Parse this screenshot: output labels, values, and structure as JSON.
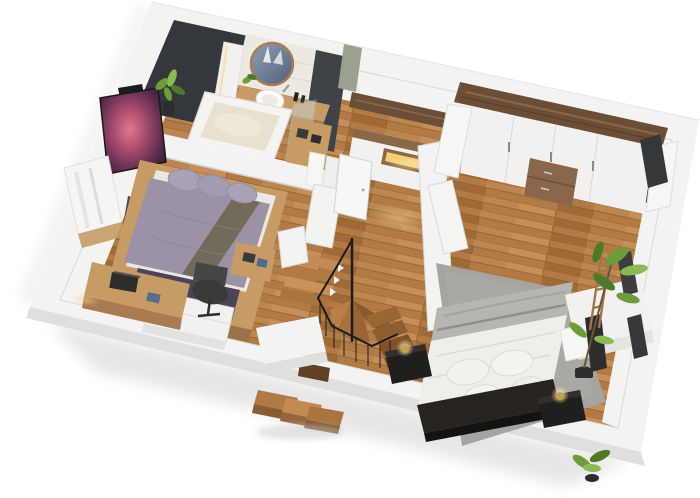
{
  "title": "3D cutaway floor plan render of an upper storey",
  "scene": {
    "description": "Isometric dollhouse-style 3D render of an apartment floor on a white background: bathroom at top left, bedroom with lavender bed and desk at left, central hallway with winder staircase, large bedroom with white bed and wardrobe at right",
    "rooms": [
      {
        "name": "bathroom",
        "items": [
          "bathtub",
          "wood-vanity-counter",
          "round-vessel-sink",
          "round-wall-mirror",
          "led-mirror-cabinet",
          "dark-accent-walls",
          "white-tile-wall",
          "hanging-towels",
          "glass-shower-screen",
          "small-plant"
        ]
      },
      {
        "name": "left-bedroom",
        "items": [
          "double-bed-lavender-bedding",
          "olive-accent-stripe",
          "purple-foot-runner",
          "white-foot-bench",
          "wood-platform",
          "desk-with-laptop",
          "office-chair",
          "wall-tv-nebula-image",
          "window-with-curtain",
          "dark-side-unit",
          "side-table",
          "potted-plant"
        ]
      },
      {
        "name": "hallway",
        "items": [
          "white-console-with-lit-niche",
          "walnut-wall-shelf",
          "open-white-door",
          "warm-floor-light",
          "sage-wall-accent"
        ]
      },
      {
        "name": "staircase",
        "items": [
          "upper-wood-flight",
          "winder-treads",
          "lower-wood-flight",
          "black-metal-railing",
          "balusters",
          "white-half-walls",
          "external-steps-below-front-wall"
        ]
      },
      {
        "name": "right-bedroom",
        "items": [
          "double-bed-white-bedding",
          "gray-folded-blanket",
          "black-headboard",
          "black-nightstand-left",
          "black-nightstand-right",
          "brass-ball-lamps",
          "gray-area-rug",
          "white-wardrobe-walnut-top",
          "open-folding-doors",
          "entry-door",
          "white-wall-console",
          "dark-tv-panel",
          "wood-ladder",
          "dark-framed-windows",
          "tall-potted-plant",
          "small-plant-front"
        ]
      }
    ],
    "background": "plain white with soft drop shadow below walls"
  },
  "palette": {
    "bg": "#ffffff",
    "wall-top": "#f3f3f1",
    "wall-face": "#dfe0de",
    "wall-shadow": "#c8c9c7",
    "wall-line": "#d8d9d7",
    "plank1": "#b27a45",
    "plank2": "#c58f57",
    "plank3": "#a06a38",
    "plank-line": "#8a5c31",
    "dark-wall": "#34383c",
    "dark-wall2": "#3f4347",
    "tile": "#ece9e3",
    "wood-counter": "#c79b66",
    "walnut": "#6b4e38",
    "walnut-light": "#8a6749",
    "tub-white": "#f5f4f2",
    "tub-inner": "#e9e1d0",
    "lavender": "#9b93a5",
    "lavender-light": "#aaa2b4",
    "olive": "#6c6852",
    "purple-dark": "#4a4458",
    "bed-white": "#efeeea",
    "gray-blanket": "#b7b5b1",
    "bed-frame": "#262321",
    "rug-gray": "#a5a4a0",
    "railing-black": "#1c1c1c",
    "brass": "#c7a24a",
    "lamp-glow": "#f5e6ae",
    "leaf-green": "#6f9c3a",
    "leaf-dark": "#4e7a28",
    "leaf-light": "#8cba52",
    "niche-glow": "#f4cd78",
    "glass-blue": "#cfe0e8",
    "sage": "#9aa18d",
    "pot-dark": "#2b2d2f",
    "furn-white": "#f2f1ef",
    "chair-dark": "#3a3a38",
    "nebula-pink": "#e2798c",
    "nebula-purple": "#55284a"
  }
}
